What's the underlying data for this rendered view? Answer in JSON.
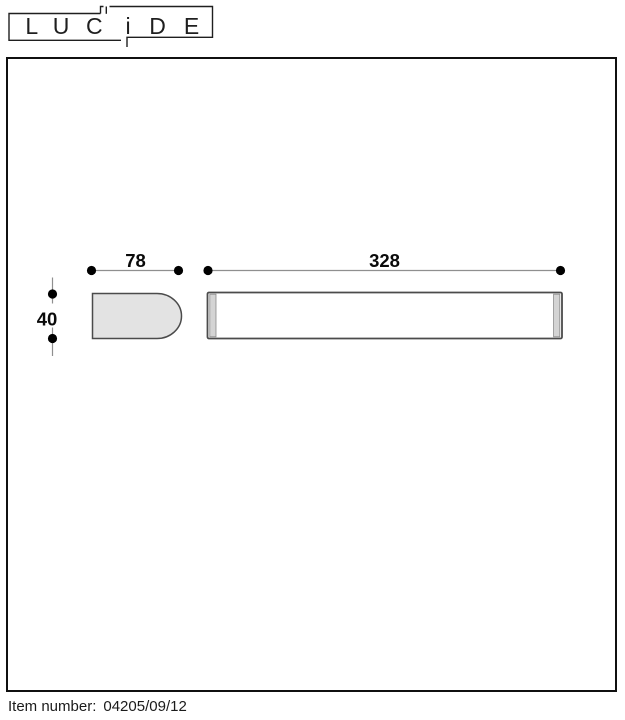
{
  "logo": {
    "letters": [
      "L",
      "U",
      "C",
      "i",
      "D",
      "E"
    ]
  },
  "drawing": {
    "side_width_label": "78",
    "front_width_label": "328",
    "height_label": "40"
  },
  "footer": {
    "label": "Item number:",
    "value": "04205/09/12"
  },
  "colors": {
    "ink": "#1f1f1f",
    "dim_line": "#8f8f8f",
    "shape_fill": "#e3e3e3",
    "cap_fill": "#d4d4d4",
    "outline_gray": "#4b4b4b"
  }
}
